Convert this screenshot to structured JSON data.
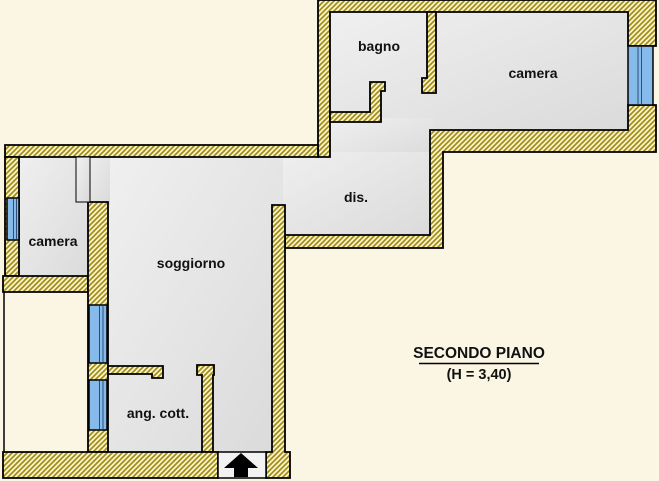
{
  "plan": {
    "title": "SECONDO PIANO",
    "height_note": "(H = 3,40)",
    "rooms": {
      "bagno": {
        "label": "bagno"
      },
      "camera_top": {
        "label": "camera"
      },
      "dis": {
        "label": "dis."
      },
      "camera_left": {
        "label": "camera"
      },
      "soggiorno": {
        "label": "soggiorno"
      },
      "ang_cott": {
        "label": "ang. cott."
      }
    },
    "entrance_symbol": "entrance-arrow-up",
    "window_count": 4
  },
  "colors": {
    "background": "#FBF6E4",
    "wall_hatch_stripe": "#A08F14",
    "wall_hatch_bg": "#FAF3CF",
    "floor_light": "#F0F0F0",
    "floor_dark": "#DADADA",
    "entrance_floor": "#F2F2F2",
    "window_blue": "#85BAEA",
    "window_line": "#2A4D7A",
    "outline": "#000000"
  }
}
